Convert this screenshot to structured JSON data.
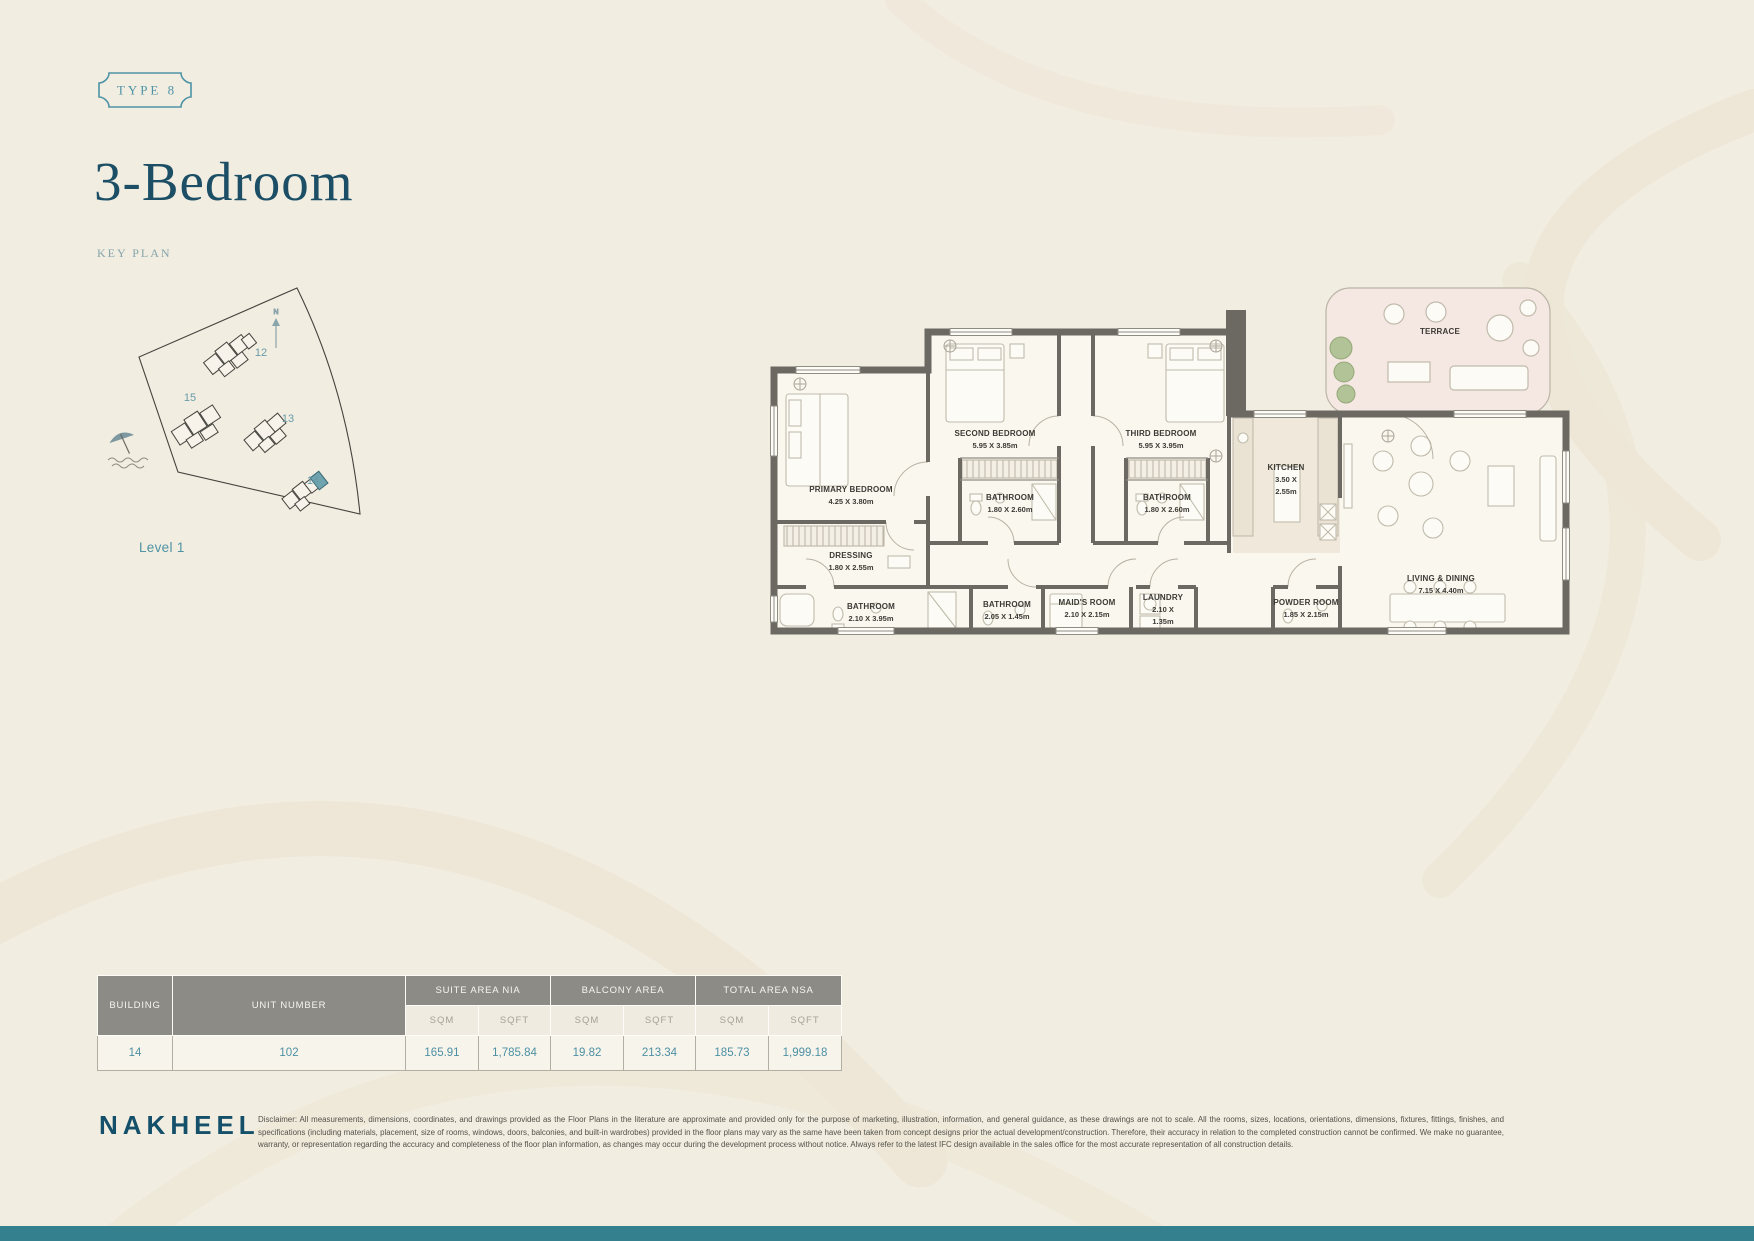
{
  "page": {
    "badge": "TYPE 8",
    "title": "3-Bedroom",
    "key_plan_label": "KEY PLAN",
    "level_label": "Level 1"
  },
  "key_plan": {
    "north_label": "N",
    "buildings": [
      "12",
      "15",
      "13",
      "14"
    ]
  },
  "plan": {
    "rooms": {
      "primary_bedroom": {
        "name": "PRIMARY BEDROOM",
        "dims": "4.25 X 3.80m"
      },
      "second_bedroom": {
        "name": "SECOND BEDROOM",
        "dims": "5.95 X 3.85m"
      },
      "third_bedroom": {
        "name": "THIRD BEDROOM",
        "dims": "5.95 X 3.95m"
      },
      "bathroom_second": {
        "name": "BATHROOM",
        "dims": "1.80 X 2.60m"
      },
      "bathroom_third": {
        "name": "BATHROOM",
        "dims": "1.80 X 2.60m"
      },
      "kitchen": {
        "name": "KITCHEN",
        "dims_l1": "3.50 X",
        "dims_l2": "2.55m"
      },
      "terrace": {
        "name": "TERRACE"
      },
      "living_dining": {
        "name": "LIVING & DINING",
        "dims": "7.15 X 4.40m"
      },
      "dressing": {
        "name": "DRESSING",
        "dims": "1.80 X 2.55m"
      },
      "bathroom_primary": {
        "name": "BATHROOM",
        "dims": "2.10 X 3.95m"
      },
      "bathroom_maid": {
        "name": "BATHROOM",
        "dims": "2.05 X 1.45m"
      },
      "maids_room": {
        "name": "MAID'S ROOM",
        "dims": "2.10 X 2.15m"
      },
      "laundry": {
        "name": "LAUNDRY",
        "dims_l1": "2.10 X",
        "dims_l2": "1.35m"
      },
      "powder_room": {
        "name": "POWDER ROOM",
        "dims": "1.85 X 2.15m"
      }
    }
  },
  "area_table": {
    "col_building": "BUILDING",
    "col_unit": "UNIT NUMBER",
    "group_suite": "SUITE AREA NIA",
    "group_balcony": "BALCONY AREA",
    "group_total": "TOTAL AREA NSA",
    "unit_sqm": "SQM",
    "unit_sqft": "SQFT",
    "row": {
      "building": "14",
      "unit": "102",
      "suite_sqm": "165.91",
      "suite_sqft": "1,785.84",
      "balcony_sqm": "19.82",
      "balcony_sqft": "213.34",
      "total_sqm": "185.73",
      "total_sqft": "1,999.18"
    }
  },
  "footer": {
    "brand": "NAKHEEL",
    "disclaimer": "Disclaimer: All measurements, dimensions, coordinates, and drawings provided as the Floor Plans in the literature are approximate and provided only for the purpose of marketing, illustration, information, and general guidance, as these drawings are not to scale. All the rooms, sizes, locations, orientations, dimensions, fixtures, fittings, finishes, and specifications (including materials, placement, size of rooms, windows, doors, balconies, and built-in wardrobes) provided in the floor plans may vary as the same have been taken from concept designs prior the actual development/construction. Therefore, their accuracy in relation to the completed construction cannot be confirmed. We make no guarantee, warranty, or representation regarding the accuracy and completeness of the floor plan information, as changes may occur during the development process without notice. Always refer to the latest IFC design available in the sales office for the most accurate representation of all construction details."
  },
  "colors": {
    "accent_teal": "#4e93a6",
    "title_navy": "#1c4f66",
    "wall_gray": "#6b6962",
    "terrace_pink": "#f5e7e2",
    "bottom_bar": "#35808f",
    "table_header_gray": "#8c8b85"
  }
}
